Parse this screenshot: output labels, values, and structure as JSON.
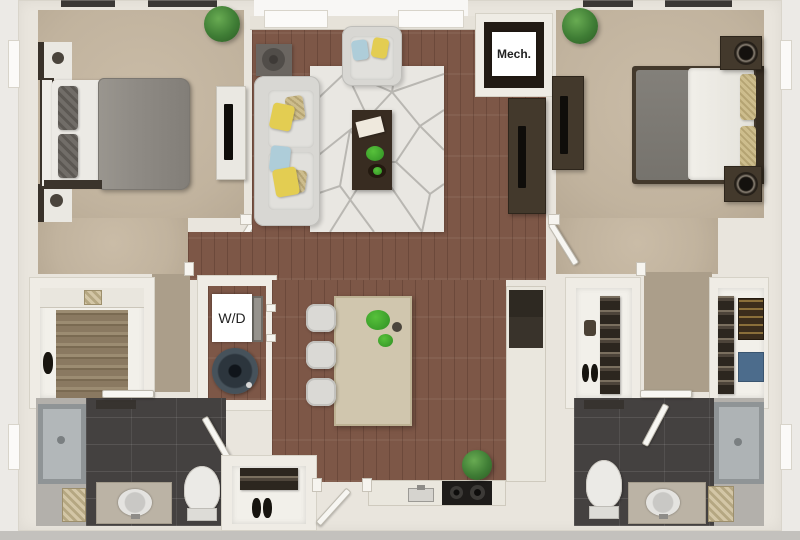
{
  "labels": {
    "mech_room": "Mech.",
    "washer_dryer": "W/D"
  },
  "palette": {
    "wood_floor": "#7d5747",
    "bedroom_carpet": "#c1b39e",
    "hallway_carpet": "#ab9e8a",
    "bathroom_tile": "#444140",
    "wall": "#efece5",
    "outside_background": "#eceae6",
    "closet_floor": "#f2f0ea",
    "kitchen_island": "#d0c6ae",
    "area_rug": "#e9e7e2",
    "sofa_gray": "#d8d7d3",
    "pillow_yellow": "#e3cd52",
    "pillow_blue": "#aecdd9",
    "dark_wood_furniture": "#43392c",
    "plant_green": "#3f7d35",
    "mech_closet_floor": "#221b14",
    "washer_color": "#46525b",
    "tub_shower_gray": "#aeb3b5"
  }
}
